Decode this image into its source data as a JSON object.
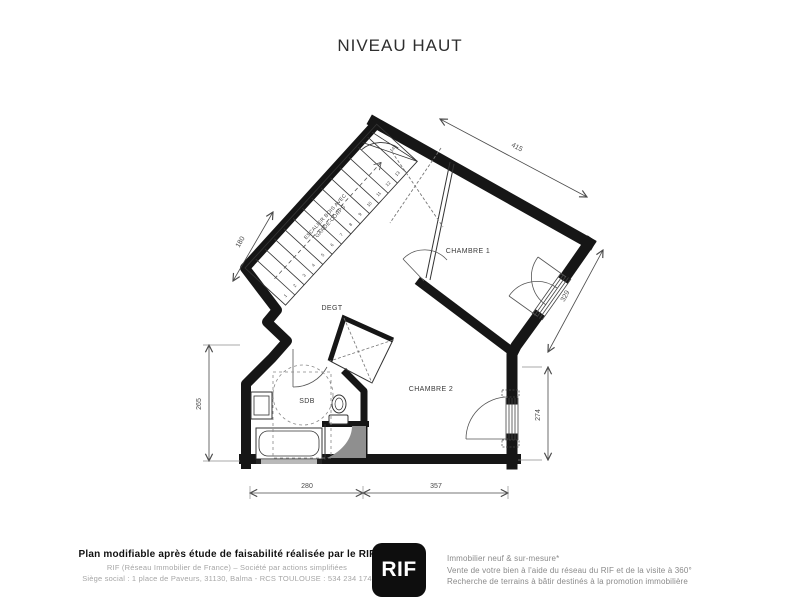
{
  "page": {
    "title": "NIVEAU HAUT",
    "background": "#ffffff"
  },
  "plan": {
    "rooms": {
      "chambre1": "CHAMBRE 1",
      "chambre2": "CHAMBRE 2",
      "degt": "DEGT",
      "sdb": "SDB"
    },
    "stairs": {
      "note_line1": "ESCALIER BOIS AVEC",
      "note_line2": "GARDE-CORPS",
      "steps": [
        "1",
        "2",
        "3",
        "4",
        "5",
        "6",
        "7",
        "8",
        "9",
        "10",
        "11",
        "12",
        "13",
        "14"
      ]
    },
    "dimensions": {
      "top": "415",
      "upper_left": "180",
      "upper_right": "329",
      "lower_right": "274",
      "lower_left": "265",
      "bottom_left": "280",
      "bottom_right": "357"
    },
    "colors": {
      "wall": "#161616",
      "dimension": "#4a4a4a",
      "shower_fill": "#8f8f8f"
    }
  },
  "footer": {
    "left": {
      "line1": "Plan modifiable après étude de faisabilité réalisée par le RIF",
      "line2": "RIF (Réseau Immobilier de France) – Société par actions simplifiées",
      "line3": "Siège social : 1 place de Paveurs, 31130, Balma - RCS TOULOUSE : 534 234 174"
    },
    "logo": {
      "text": "RIF"
    },
    "right": {
      "line1": "Immobilier neuf & sur-mesure*",
      "line2": "Vente de votre bien à l'aide du réseau du RIF et de la visite à 360°",
      "line3": "Recherche de terrains à bâtir destinés à la promotion immobilière"
    }
  }
}
